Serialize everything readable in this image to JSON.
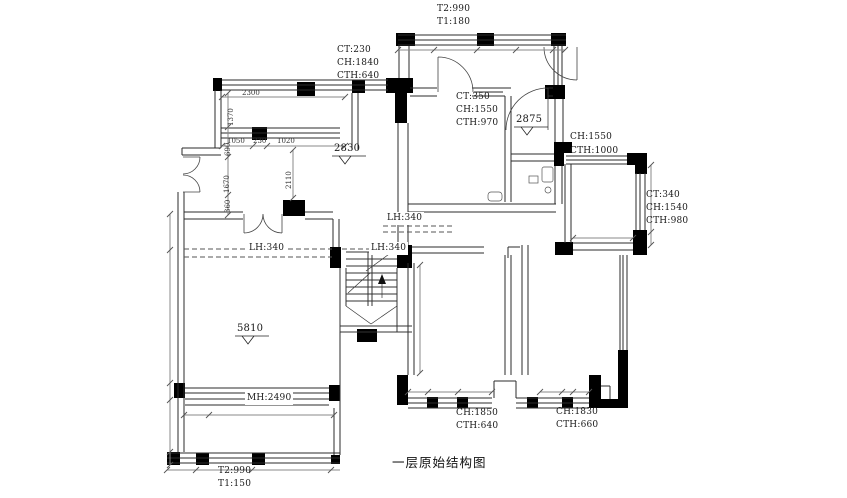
{
  "title": "一层原始结构图",
  "labels": {
    "top_wall": [
      "T2:990",
      "T1:180"
    ],
    "ct_top_left": [
      "CT:230",
      "CH:1840",
      "CTH:640"
    ],
    "ct_center": [
      "CT:350",
      "CH:1550",
      "CTH:970"
    ],
    "ch_right": [
      "CH:1550",
      "CTH:1000"
    ],
    "ct_far_right": [
      "CT:340",
      "CH:1540",
      "CTH:980"
    ],
    "lh_hall": "LH:340",
    "lh_living": "LH:340",
    "lh_stairs": "LH:340",
    "mh_window": "MH:2490",
    "ch_bottom_left": [
      "CH:1850",
      "CTH:640"
    ],
    "ch_bottom_right": [
      "CH:1830",
      "CTH:660"
    ],
    "bottom_wall": [
      "T2:990",
      "T1:150"
    ]
  },
  "elevations": {
    "hall": "2830",
    "room_right": "2875",
    "living": "5810"
  },
  "dimensions": {
    "w2300": "2300",
    "w1050": "1050",
    "w230": "230",
    "w1020": "1020",
    "v1370": "1370",
    "v690": "690",
    "v1670": "1670",
    "v360": "360",
    "v2110": "2110"
  }
}
